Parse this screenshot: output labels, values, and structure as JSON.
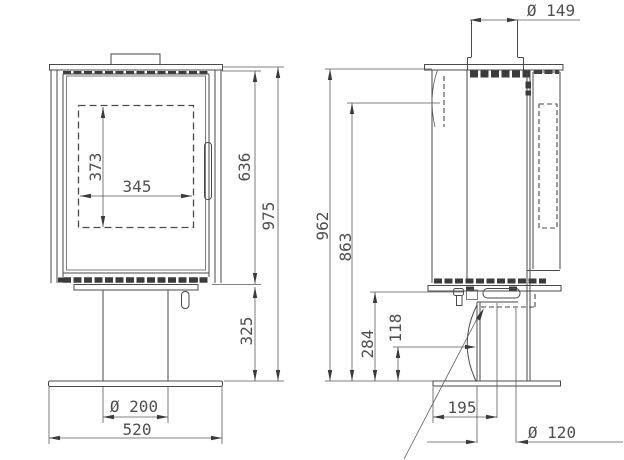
{
  "drawing": {
    "type": "technical-dimension-drawing",
    "subject": "stove two-view drawing (front view and side view)",
    "background_color": "#ffffff",
    "line_color": "#4a4a4a",
    "text_color": "#4f4f4f",
    "front_view": {
      "dimensions": {
        "glass_height": "373",
        "glass_width": "345",
        "body_height": "636",
        "overall_height": "975",
        "pedestal_height": "325",
        "pedestal_diameter": "Ø 200",
        "base_width": "520"
      }
    },
    "side_view": {
      "dimensions": {
        "flue_diameter": "Ø 149",
        "height_to_top_plate": "962",
        "height_upper": "863",
        "height_under_body": "284",
        "height_low": "118",
        "inlet_offset": "195",
        "air_inlet_diameter": "Ø 120"
      }
    }
  }
}
